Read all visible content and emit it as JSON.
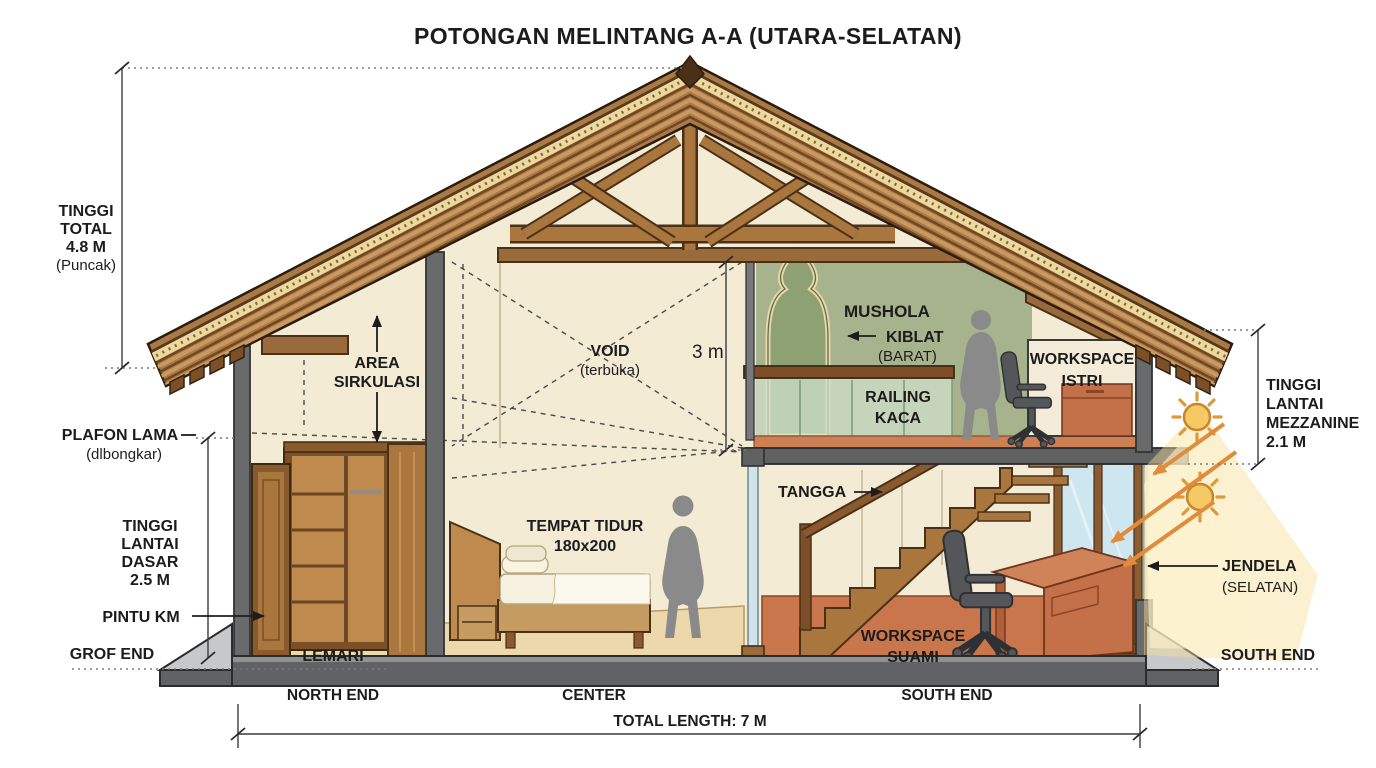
{
  "labels": {
    "title": "POTONGAN MELINTANG A-A (UTARA-SELATAN)",
    "tinggi_total": {
      "l1": "TINGGI",
      "l2": "TOTAL",
      "l3": "4.8 M",
      "l4": "(Puncak)"
    },
    "plafon_lama": {
      "l1": "PLAFON LAMA",
      "l2": "(dlbongkar)"
    },
    "tinggi_dasar": {
      "l1": "TINGGI",
      "l2": "LANTAI",
      "l3": "DASAR",
      "l4": "2.5 M"
    },
    "pintu_km": "PINTU KM",
    "grof_end": "GROF END",
    "area_sirkulasi": {
      "l1": "AREA",
      "l2": "SIRKULASI"
    },
    "void": {
      "l1": "VOID",
      "l2": "(terbuka)"
    },
    "void_height": "3 m",
    "mushola": "MUSHOLA",
    "kiblat": {
      "l1": "KIBLAT",
      "l2": "(BARAT)"
    },
    "railing_kaca": {
      "l1": "RAILING",
      "l2": "KACA"
    },
    "workspace_istri": {
      "l1": "WORKSPACE",
      "l2": "ISTRI"
    },
    "tangga": "TANGGA",
    "tempat_tidur": {
      "l1": "TEMPAT TIDUR",
      "l2": "180x200"
    },
    "lemari": "LEMARI",
    "workspace_suami": {
      "l1": "WORKSPACE",
      "l2": "SUAMI"
    },
    "jendela": {
      "l1": "JENDELA",
      "l2": "(SELATAN)"
    },
    "mezzanine": {
      "l1": "TINGGI",
      "l2": "LANTAI",
      "l3": "MEZZANINE",
      "l4": "2.1 M"
    },
    "south_end_right": "SOUTH END",
    "north_end": "NORTH END",
    "center": "CENTER",
    "south_end_bottom": "SOUTH END",
    "total_length": "TOTAL LENGTH: 7 M"
  },
  "colors": {
    "roof_wood": "#aa7a46",
    "roof_dark_stripe": "#6f4724",
    "batten_trim": "#ecd9a0",
    "wall_gray": "#686a6c",
    "interior_cream": "#f4ebd5",
    "mushola_green": "#a7b38d",
    "terracotta_floor": "#c9764c",
    "mezzanine_floor": "#cd8054",
    "bedroom_floor": "#ecd8aa",
    "window_glass": "#cde6f0",
    "railing_glass": "#cfe0cb",
    "foundation_gray": "#606265",
    "sun_yellow": "#f5c963",
    "light_beam": "#f6e09a",
    "silhouette_gray": "#8a8a8a",
    "text": "#1c1c1c"
  }
}
